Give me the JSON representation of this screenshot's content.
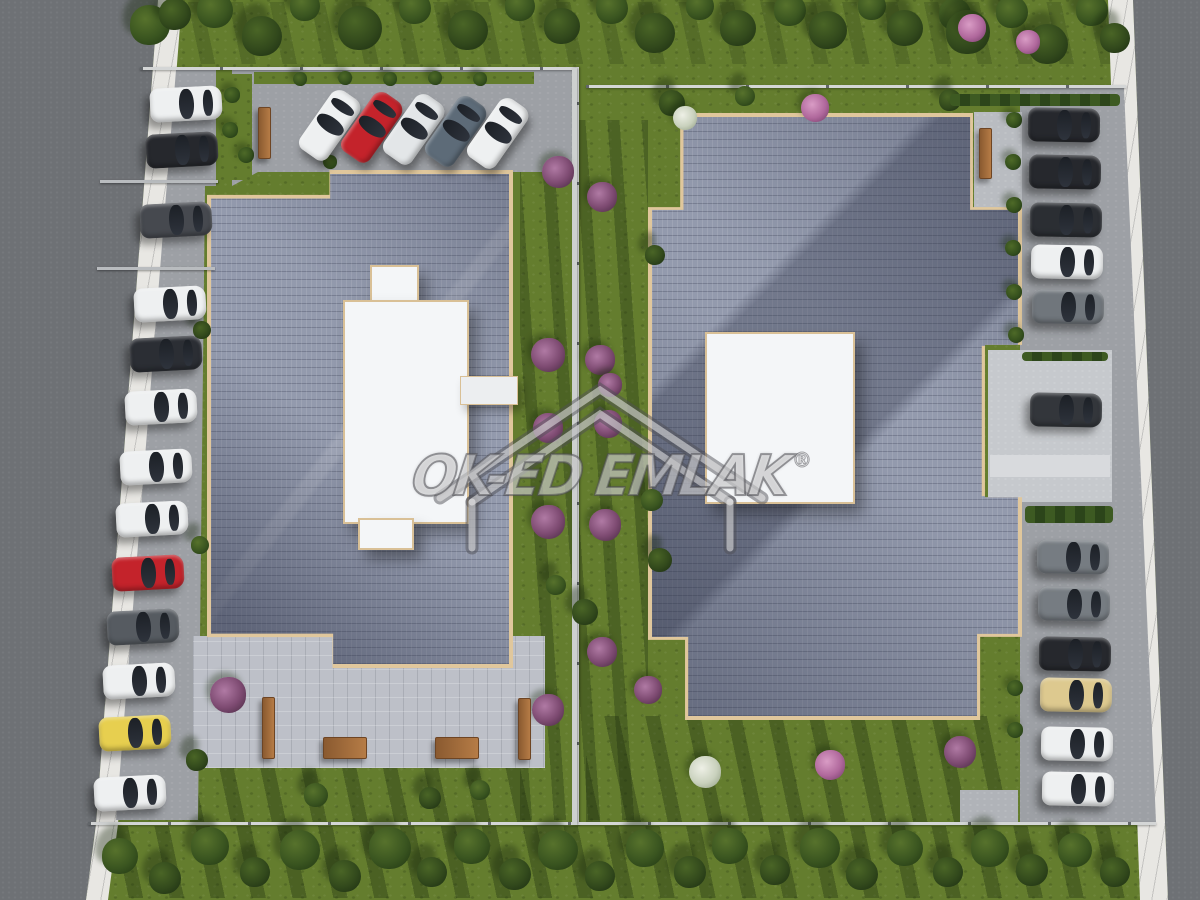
{
  "watermark": {
    "text": "OK-ED EMLAK",
    "registered": "®"
  },
  "palette": {
    "grass": "#647d2e",
    "road": "#6e7175",
    "sidewalk": "#e8e7e3",
    "roof_tiles": "#939aad",
    "roof_trim": "#e0c79c",
    "courtyard": "#bdc0c8",
    "pavement": "#9da0a5",
    "fence": "#d4d6d6",
    "bench_wood": "#b67c46",
    "white_structure": "#f4f6f8"
  },
  "scene": {
    "cars": {
      "left_column": [
        [
          150,
          87,
          "#eef0f1"
        ],
        [
          146,
          133,
          "#26282d"
        ],
        [
          140,
          203,
          "#46494f"
        ],
        [
          134,
          287,
          "#eef0f1"
        ],
        [
          130,
          337,
          "#2b2e34"
        ],
        [
          125,
          390,
          "#eef0f1"
        ],
        [
          120,
          450,
          "#eef0f1"
        ],
        [
          116,
          502,
          "#eef0f1"
        ],
        [
          112,
          556,
          "#c4232b"
        ],
        [
          107,
          610,
          "#565b61"
        ],
        [
          103,
          664,
          "#eef0f1"
        ],
        [
          99,
          716,
          "#e7cf4f"
        ],
        [
          94,
          776,
          "#eef0f1"
        ]
      ],
      "top_row": [
        [
          294,
          108,
          "#eef0f1"
        ],
        [
          336,
          110,
          "#c4232b"
        ],
        [
          378,
          112,
          "#e3e6e8"
        ],
        [
          420,
          114,
          "#5d6b78"
        ],
        [
          462,
          116,
          "#eef0f1"
        ]
      ],
      "right_column": [
        [
          1028,
          108,
          "#26282d"
        ],
        [
          1029,
          155,
          "#26282d"
        ],
        [
          1030,
          203,
          "#2b2e33"
        ],
        [
          1031,
          245,
          "#eef0f1"
        ],
        [
          1032,
          290,
          "#70767c"
        ],
        [
          1030,
          393,
          "#33363b"
        ],
        [
          1037,
          540,
          "#767c82"
        ],
        [
          1038,
          587,
          "#767c82"
        ],
        [
          1039,
          637,
          "#26282d"
        ],
        [
          1040,
          678,
          "#ddc98f"
        ],
        [
          1041,
          727,
          "#eef0f1"
        ],
        [
          1042,
          772,
          "#eef0f1"
        ]
      ]
    },
    "trees": [
      [
        150,
        25,
        20,
        0
      ],
      [
        175,
        14,
        16,
        1
      ],
      [
        215,
        10,
        18,
        0
      ],
      [
        262,
        36,
        20,
        1
      ],
      [
        305,
        6,
        15,
        0
      ],
      [
        360,
        28,
        22,
        1
      ],
      [
        415,
        8,
        16,
        0
      ],
      [
        468,
        30,
        20,
        1
      ],
      [
        520,
        6,
        15,
        0
      ],
      [
        562,
        26,
        18,
        1
      ],
      [
        612,
        8,
        16,
        0
      ],
      [
        655,
        33,
        20,
        1
      ],
      [
        700,
        6,
        14,
        0
      ],
      [
        738,
        28,
        18,
        1
      ],
      [
        790,
        10,
        16,
        0
      ],
      [
        828,
        30,
        19,
        1
      ],
      [
        872,
        6,
        14,
        0
      ],
      [
        905,
        28,
        18,
        1
      ],
      [
        955,
        14,
        16,
        0
      ],
      [
        968,
        32,
        22,
        1
      ],
      [
        1012,
        12,
        16,
        0
      ],
      [
        1048,
        44,
        20,
        1
      ],
      [
        1092,
        10,
        16,
        0
      ],
      [
        1115,
        38,
        15,
        1
      ],
      [
        672,
        103,
        13,
        1
      ],
      [
        745,
        96,
        10,
        0
      ],
      [
        950,
        100,
        11,
        1
      ],
      [
        120,
        856,
        18,
        0
      ],
      [
        165,
        878,
        16,
        1
      ],
      [
        210,
        846,
        19,
        0
      ],
      [
        255,
        872,
        15,
        1
      ],
      [
        300,
        850,
        20,
        0
      ],
      [
        345,
        876,
        16,
        1
      ],
      [
        390,
        848,
        21,
        0
      ],
      [
        432,
        872,
        15,
        1
      ],
      [
        472,
        846,
        18,
        0
      ],
      [
        515,
        874,
        16,
        1
      ],
      [
        558,
        850,
        20,
        0
      ],
      [
        600,
        876,
        15,
        1
      ],
      [
        645,
        848,
        19,
        0
      ],
      [
        690,
        872,
        16,
        1
      ],
      [
        730,
        846,
        18,
        0
      ],
      [
        775,
        870,
        15,
        1
      ],
      [
        820,
        848,
        20,
        0
      ],
      [
        862,
        874,
        16,
        1
      ],
      [
        905,
        848,
        18,
        0
      ],
      [
        948,
        872,
        15,
        1
      ],
      [
        990,
        848,
        19,
        0
      ],
      [
        1032,
        870,
        16,
        1
      ],
      [
        1075,
        850,
        17,
        0
      ],
      [
        1115,
        872,
        15,
        1
      ],
      [
        202,
        330,
        9,
        1
      ],
      [
        200,
        545,
        9,
        0
      ],
      [
        197,
        760,
        11,
        1
      ],
      [
        585,
        612,
        13,
        1
      ],
      [
        556,
        585,
        10,
        0
      ],
      [
        655,
        255,
        10,
        1
      ],
      [
        652,
        500,
        11,
        0
      ],
      [
        660,
        560,
        12,
        1
      ],
      [
        316,
        795,
        12,
        0
      ],
      [
        430,
        798,
        11,
        1
      ],
      [
        480,
        790,
        10,
        0
      ]
    ],
    "bushes": [
      [
        558,
        172,
        16,
        "purple"
      ],
      [
        602,
        197,
        15,
        "purple"
      ],
      [
        548,
        355,
        17,
        "purple"
      ],
      [
        600,
        360,
        15,
        "purple"
      ],
      [
        548,
        428,
        15,
        "purple"
      ],
      [
        608,
        424,
        14,
        "purple"
      ],
      [
        548,
        522,
        17,
        "purple"
      ],
      [
        605,
        525,
        16,
        "purple"
      ],
      [
        602,
        652,
        15,
        "purple"
      ],
      [
        648,
        690,
        14,
        "purple"
      ],
      [
        228,
        695,
        18,
        "purple"
      ],
      [
        548,
        710,
        16,
        "purple"
      ],
      [
        960,
        752,
        16,
        "purple"
      ],
      [
        830,
        765,
        15,
        "pink"
      ],
      [
        705,
        772,
        16,
        "white"
      ],
      [
        815,
        108,
        14,
        "pink"
      ],
      [
        685,
        118,
        12,
        "white"
      ],
      [
        972,
        28,
        14,
        "pink"
      ],
      [
        1028,
        42,
        12,
        "pink"
      ],
      [
        610,
        385,
        12,
        "purple"
      ],
      [
        232,
        95,
        8,
        "green"
      ],
      [
        230,
        130,
        8,
        "green"
      ],
      [
        246,
        155,
        8,
        "green"
      ],
      [
        330,
        162,
        7,
        "green"
      ],
      [
        300,
        79,
        7,
        "green"
      ],
      [
        345,
        78,
        7,
        "green"
      ],
      [
        390,
        79,
        7,
        "green"
      ],
      [
        435,
        78,
        7,
        "green"
      ],
      [
        480,
        79,
        7,
        "green"
      ],
      [
        1014,
        120,
        8,
        "green"
      ],
      [
        1013,
        162,
        8,
        "green"
      ],
      [
        1014,
        205,
        8,
        "green"
      ],
      [
        1013,
        248,
        8,
        "green"
      ],
      [
        1014,
        292,
        8,
        "green"
      ],
      [
        1016,
        335,
        8,
        "green"
      ],
      [
        1015,
        688,
        8,
        "green"
      ],
      [
        1015,
        730,
        8,
        "green"
      ]
    ],
    "benches": [
      [
        258,
        107,
        11,
        50
      ],
      [
        979,
        128,
        11,
        49
      ],
      [
        262,
        697,
        11,
        60
      ],
      [
        518,
        698,
        11,
        60
      ],
      [
        323,
        737,
        42,
        20
      ],
      [
        435,
        737,
        42,
        20
      ]
    ],
    "hedges": [
      [
        1022,
        352,
        86,
        9
      ],
      [
        1025,
        506,
        88,
        17
      ],
      [
        950,
        94,
        170,
        12
      ]
    ],
    "rails": [
      [
        100,
        180,
        118
      ],
      [
        97,
        267,
        118
      ]
    ]
  }
}
